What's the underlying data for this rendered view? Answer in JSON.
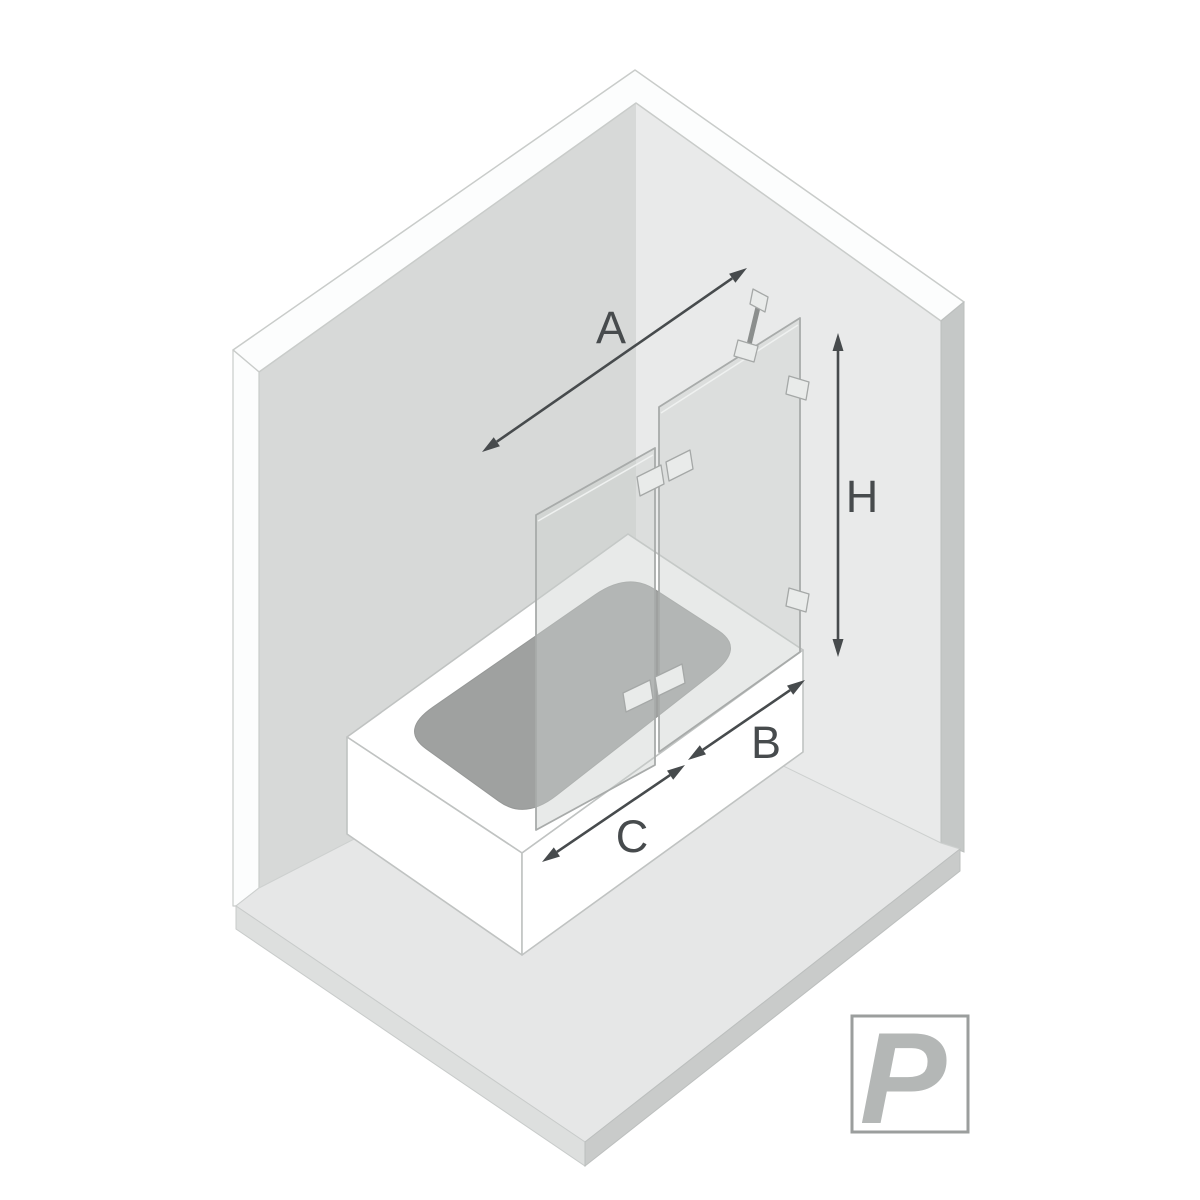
{
  "dimensions": {
    "arrow_a": {
      "label": "A"
    },
    "arrow_h": {
      "label": "H"
    },
    "arrow_b": {
      "label": "B"
    },
    "arrow_c": {
      "label": "C"
    }
  },
  "badge": {
    "label": "P"
  },
  "colors": {
    "dimension_ink": "#474b4d",
    "badge_ink": "#b4b7b6",
    "badge_border": "#9b9e9d",
    "wall_left": "#d7d9d8",
    "wall_right": "#e9eaea",
    "wall_edge_right": "#c5c8c7",
    "wall_band": "#fcfdfd",
    "floor": "#e6e7e7",
    "floor_edge_left": "#dddfde",
    "floor_edge_right": "#c9cbca",
    "tub_basin": "#9fa1a0",
    "glass_edge": "#a8abaa",
    "metal": "#8b8e8d"
  }
}
